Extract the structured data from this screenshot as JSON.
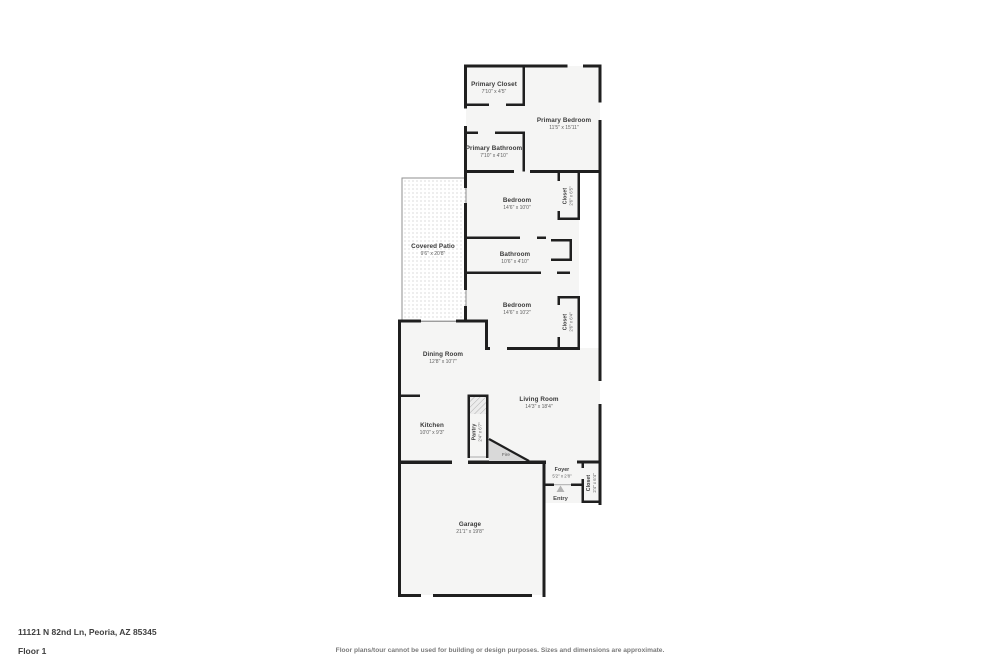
{
  "floor_plan": {
    "address": "11121 N 82nd Ln, Peoria, AZ 85345",
    "floor_label": "Floor 1",
    "disclaimer": "Floor plans/tour cannot be used for building or design purposes. Sizes and dimensions are approximate.",
    "colors": {
      "wall": "#1f1f1f",
      "room_fill": "#f5f5f4",
      "patio_dot": "#c4c4c4",
      "fireplace_fill": "#d9d9d9",
      "label_text": "#3a3a3a",
      "dims_text": "#606060"
    },
    "rooms": [
      {
        "name": "Primary Closet",
        "dims": "7'10\" x 4'5\""
      },
      {
        "name": "Primary Bedroom",
        "dims": "11'5\" x 15'11\""
      },
      {
        "name": "Primary Bathroom",
        "dims": "7'10\" x 4'10\""
      },
      {
        "name": "Bedroom",
        "dims": "14'6\" x 10'0\""
      },
      {
        "name": "Closet",
        "dims": "2'6\" x 6'5\""
      },
      {
        "name": "Bathroom",
        "dims": "10'6\" x 4'10\""
      },
      {
        "name": "Bedroom",
        "dims": "14'6\" x 10'2\""
      },
      {
        "name": "Closet",
        "dims": "2'6\" x 6'4\""
      },
      {
        "name": "Covered Patio",
        "dims": "9'6\" x 20'8\""
      },
      {
        "name": "Dining Room",
        "dims": "12'8\" x 10'7\""
      },
      {
        "name": "Living Room",
        "dims": "14'3\" x 18'4\""
      },
      {
        "name": "Kitchen",
        "dims": "10'0\" x 9'3\""
      },
      {
        "name": "Pantry",
        "dims": "2'4\" x 6'7\""
      },
      {
        "name": "Foyer",
        "dims": "5'2\" x 2'8\""
      },
      {
        "name": "Closet",
        "dims": "2'4\" x 6'4\""
      },
      {
        "name": "Garage",
        "dims": "21'1\" x 19'8\""
      }
    ],
    "annotations": {
      "fireplace": "Fire",
      "entry": "Entry"
    }
  }
}
